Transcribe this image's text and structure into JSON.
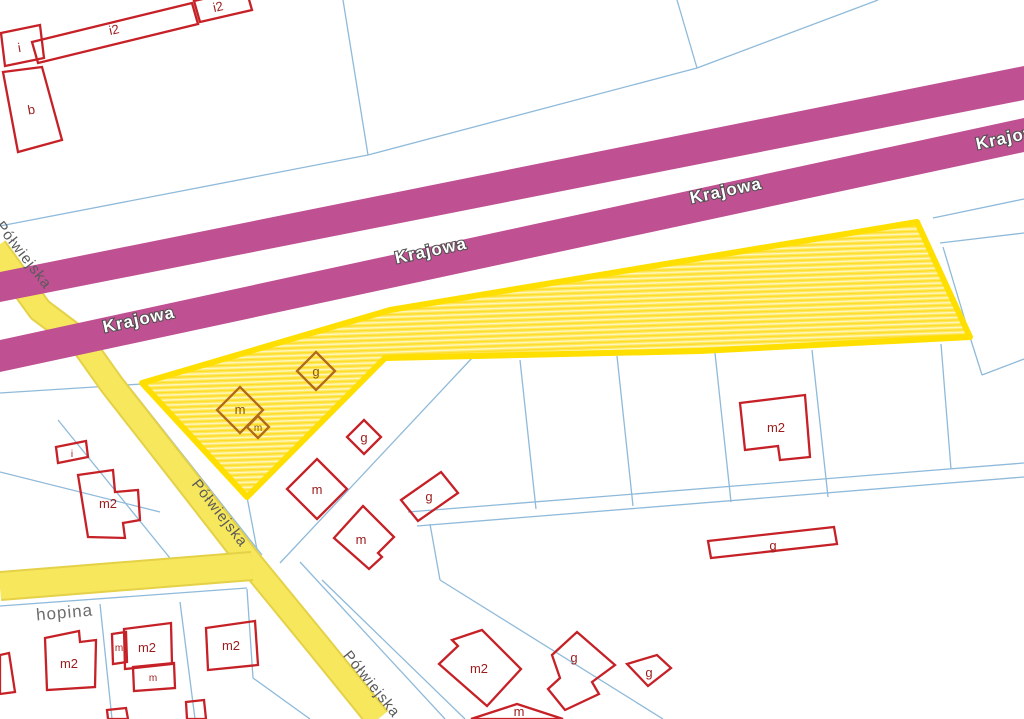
{
  "streets": {
    "krajowa": "Krajowa",
    "polwiejska": "Półwiejska",
    "chopina_partial": "hopina"
  },
  "buildings": [
    "i2",
    "i2",
    "i",
    "b",
    "g",
    "m",
    "m",
    "g",
    "m",
    "g",
    "m",
    "m2",
    "g",
    "i",
    "m2",
    "m2",
    "m",
    "m2",
    "m",
    "m2",
    "m2",
    "g",
    "g",
    "m"
  ],
  "colors": {
    "krajowa_road": "#bf5192",
    "local_road": "#f7e75c",
    "selected_parcel_border": "#ffdf00",
    "selected_parcel_fill": "#ffe85c",
    "parcel_line": "#8fbada",
    "building_outline": "#c52127",
    "building_outline_in_selection": "#b06a1a",
    "building_label": "#9c1c1c",
    "road_label_dark": "#5a5a5a",
    "krajowa_label_fill": "#ffffff"
  }
}
